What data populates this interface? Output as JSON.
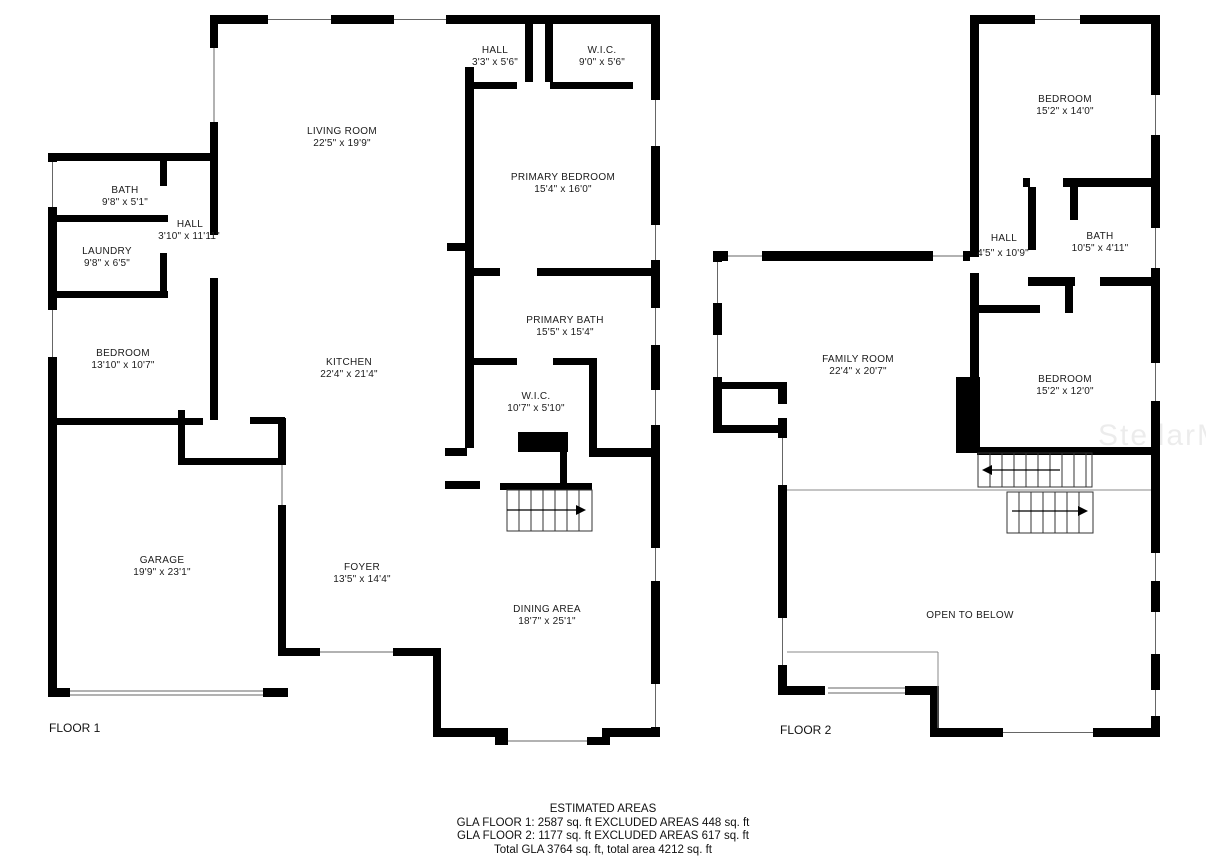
{
  "watermark": {
    "text": "StellarMLS"
  },
  "floor1": {
    "label": "FLOOR 1",
    "rooms": {
      "bath": {
        "name": "BATH",
        "dims": "9'8\" x 5'1\""
      },
      "hall": {
        "name": "HALL",
        "dims": "3'10\" x 11'11\""
      },
      "laundry": {
        "name": "LAUNDRY",
        "dims": "9'8\" x 6'5\""
      },
      "bedroom": {
        "name": "BEDROOM",
        "dims": "13'10\" x 10'7\""
      },
      "living_room": {
        "name": "LIVING ROOM",
        "dims": "22'5\" x 19'9\""
      },
      "hall_top": {
        "name": "HALL",
        "dims": "3'3\" x 5'6\""
      },
      "wic_top": {
        "name": "W.I.C.",
        "dims": "9'0\" x 5'6\""
      },
      "primary_bedroom": {
        "name": "PRIMARY BEDROOM",
        "dims": "15'4\" x 16'0\""
      },
      "primary_bath": {
        "name": "PRIMARY BATH",
        "dims": "15'5\" x 15'4\""
      },
      "wic": {
        "name": "W.I.C.",
        "dims": "10'7\" x 5'10\""
      },
      "kitchen": {
        "name": "KITCHEN",
        "dims": "22'4\" x 21'4\""
      },
      "foyer": {
        "name": "FOYER",
        "dims": "13'5\" x 14'4\""
      },
      "garage": {
        "name": "GARAGE",
        "dims": "19'9\" x 23'1\""
      },
      "dining": {
        "name": "DINING AREA",
        "dims": "18'7\" x 25'1\""
      }
    }
  },
  "floor2": {
    "label": "FLOOR 2",
    "rooms": {
      "bedroom_top": {
        "name": "BEDROOM",
        "dims": "15'2\" x 14'0\""
      },
      "hall": {
        "name": "HALL",
        "dims": "4'5\" x 10'9\""
      },
      "bath": {
        "name": "BATH",
        "dims": "10'5\" x 4'11\""
      },
      "family_room": {
        "name": "FAMILY ROOM",
        "dims": "22'4\" x 20'7\""
      },
      "bedroom": {
        "name": "BEDROOM",
        "dims": "15'2\" x 12'0\""
      },
      "open_to_below": {
        "name": "OPEN TO BELOW"
      }
    }
  },
  "footer": {
    "title": "ESTIMATED AREAS",
    "gla1": "GLA FLOOR 1: 2587 sq. ft EXCLUDED AREAS 448 sq. ft",
    "gla2": "GLA FLOOR 2: 1177 sq. ft EXCLUDED AREAS 617 sq. ft",
    "total": "Total GLA 3764 sq. ft, total area 4212 sq. ft"
  }
}
